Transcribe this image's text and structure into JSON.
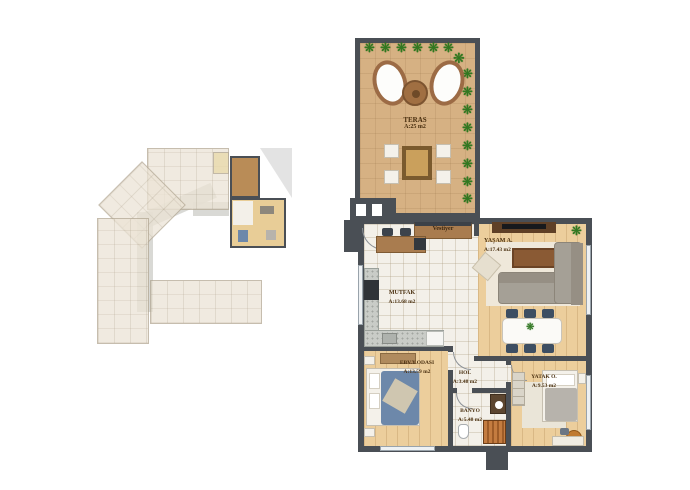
{
  "page": {
    "background": "#ffffff"
  },
  "icons": {
    "plant": "❋"
  },
  "colors": {
    "wall": "#4a4f55",
    "terrace_floor": "#d6b183",
    "wood_floor": "#ecce9c",
    "tile_floor": "#f3f0e9",
    "plant_green": "#2e7a1f",
    "overview_highlight_terrace": "#b98c57",
    "overview_highlight_rooms": "#e8cd97",
    "sofa_gray": "#a5a096",
    "dining_chair_navy": "#3d4e62",
    "bed_blue": "#6d88aa",
    "shower_orange": "#c47c40",
    "pouf_orange": "#c07a30"
  },
  "rooms": [
    {
      "id": "teras",
      "name": "TERAS",
      "area": "A:25 m2"
    },
    {
      "id": "vestiyer",
      "name": "Vestiyer",
      "area": ""
    },
    {
      "id": "yasam",
      "name": "YAŞAM A.",
      "area": "A:17.43 m2"
    },
    {
      "id": "mutfak",
      "name": "MUTFAK",
      "area": "A:13.68 m2"
    },
    {
      "id": "ebv",
      "name": "EBV.Y.ODASI",
      "area": "A:13.59 m2"
    },
    {
      "id": "hol",
      "name": "HOL",
      "area": "A:3.48 m2"
    },
    {
      "id": "banyo",
      "name": "BANYO",
      "area": "A:5.48 m2"
    },
    {
      "id": "yatak",
      "name": "YATAK O.",
      "area": "A:9.53 m2"
    }
  ]
}
